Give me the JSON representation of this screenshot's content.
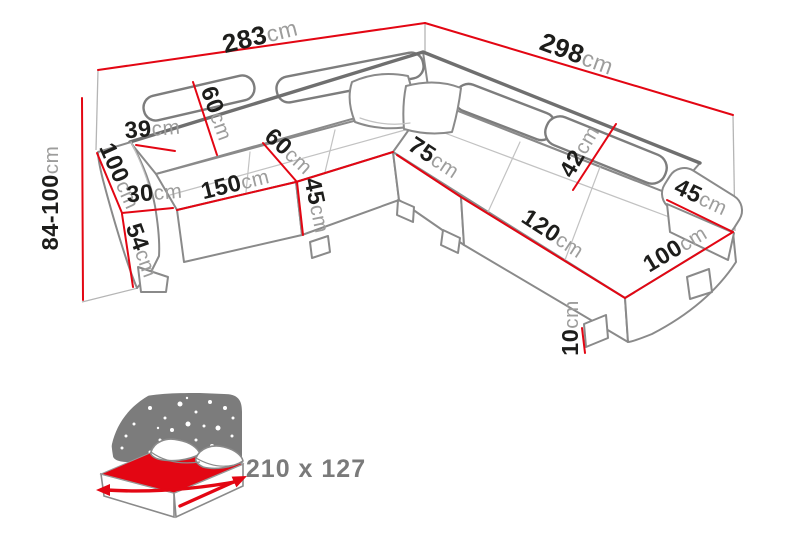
{
  "diagram": {
    "kind": "corner-sofa dimension drawing",
    "colors": {
      "dimension_line": "#e30613",
      "sofa_outline": "#8a8a8a",
      "value_text": "#1d1d1b",
      "unit_text": "#9d9d9c",
      "headboard_gray": "#7c7c7c",
      "mattress_red": "#e30613",
      "bed_label_gray": "#7a7a7a"
    },
    "sofa": {
      "labels": {
        "width_left": {
          "value": "283",
          "unit": "cm"
        },
        "width_right": {
          "value": "298",
          "unit": "cm"
        },
        "height": {
          "value": "84-100",
          "unit": "cm"
        },
        "back_top_depth": {
          "value": "39",
          "unit": "cm"
        },
        "backrest_height": {
          "value": "60",
          "unit": "cm"
        },
        "left_side_depth": {
          "value": "100",
          "unit": "cm"
        },
        "left_arm_width": {
          "value": "30",
          "unit": "cm"
        },
        "left_seat_length": {
          "value": "150",
          "unit": "cm"
        },
        "left_arm_height": {
          "value": "54",
          "unit": "cm"
        },
        "corner_seat_width": {
          "value": "60",
          "unit": "cm"
        },
        "seat_height": {
          "value": "45",
          "unit": "cm"
        },
        "corner_section_width": {
          "value": "75",
          "unit": "cm"
        },
        "headrest_height": {
          "value": "42",
          "unit": "cm"
        },
        "right_arm_width": {
          "value": "45",
          "unit": "cm"
        },
        "right_seat_length": {
          "value": "120",
          "unit": "cm"
        },
        "right_seat_depth": {
          "value": "100",
          "unit": "cm"
        },
        "leg_height": {
          "value": "10",
          "unit": "cm"
        }
      }
    },
    "sleeping_function": {
      "size_label": "210 x 127"
    }
  }
}
